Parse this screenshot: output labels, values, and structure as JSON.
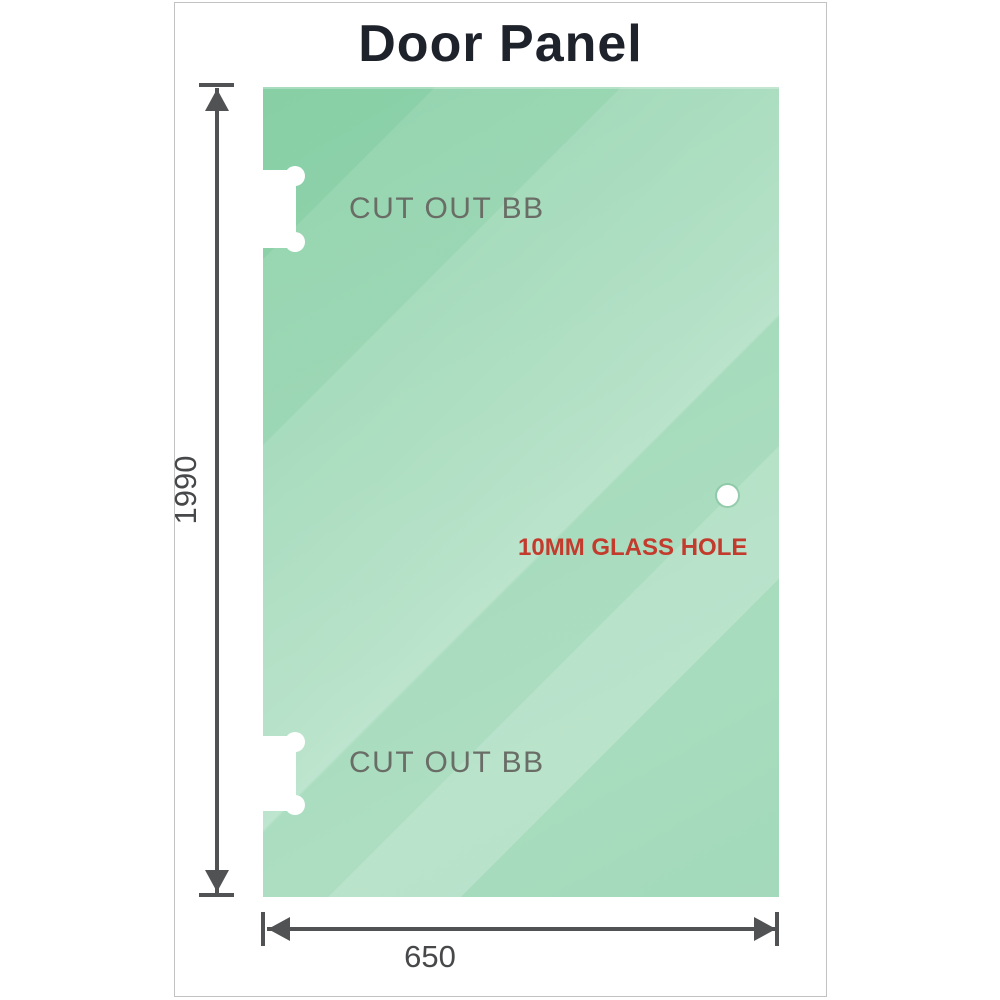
{
  "title": "Door Panel",
  "glass_panel": {
    "hole_label": "10MM GLASS HOLE",
    "cutouts": [
      {
        "label": "CUT OUT BB"
      },
      {
        "label": "CUT OUT BB"
      }
    ],
    "colors": {
      "glass_green": "#8fd2ab",
      "glass_light_reflection": "#cde9d6",
      "cutout_fill": "#ffffff"
    }
  },
  "dimensions": {
    "height": {
      "value": "1990"
    },
    "width": {
      "value": "650"
    },
    "line_color": "#515254",
    "text_color": "#47484a"
  },
  "colors": {
    "title_text": "#1e222b",
    "cutout_text": "#696d66",
    "hole_text": "#c23b2d",
    "frame_border": "#c2c2c2"
  }
}
